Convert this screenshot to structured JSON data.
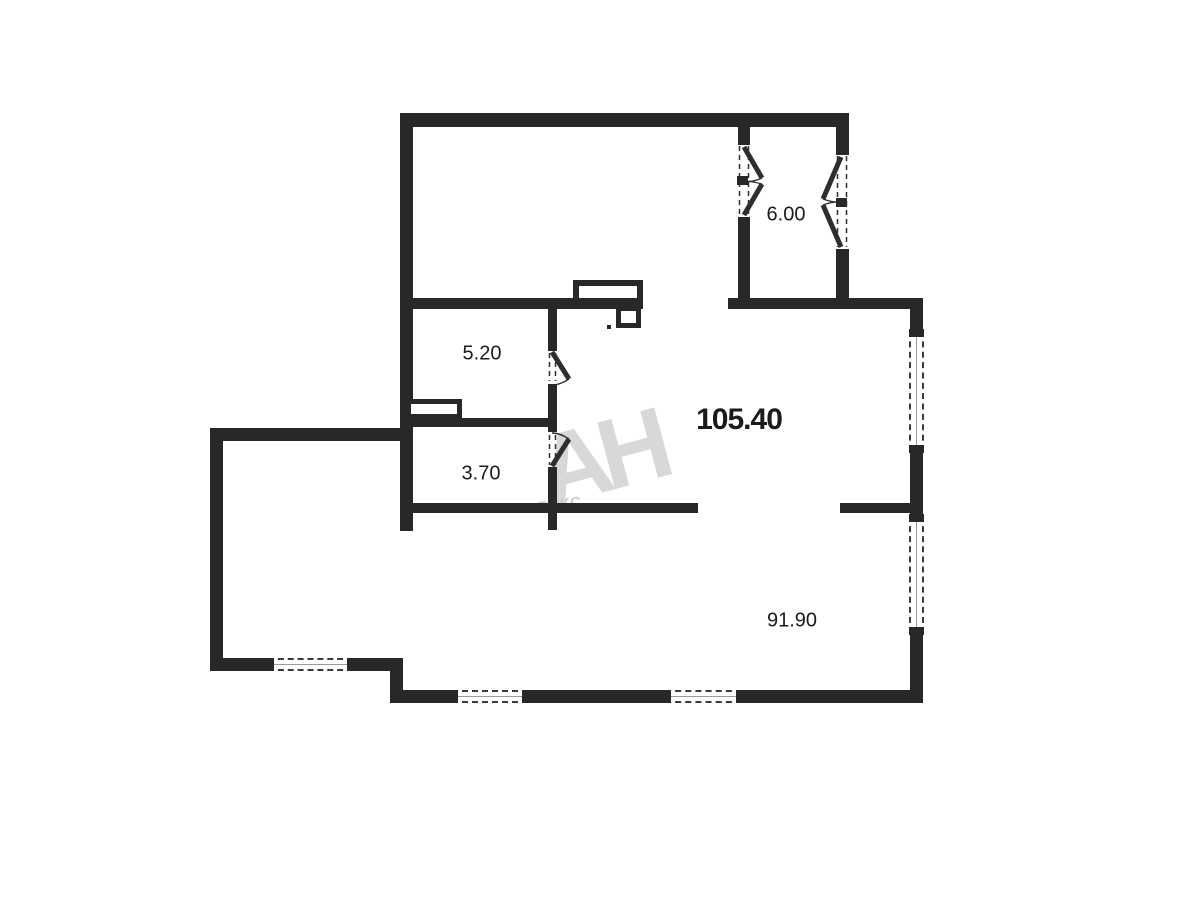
{
  "title": "apartment floor plan",
  "watermark": {
    "main": "АН",
    "sub": "РИКС"
  },
  "colors": {
    "wall": "#282828",
    "watermark": "#d8d8d8",
    "label": "#1b1b1b",
    "background": "#ffffff"
  },
  "rooms": [
    {
      "name": "balcony",
      "label": "6.00"
    },
    {
      "name": "bathroom",
      "label": "5.20"
    },
    {
      "name": "apartment-total",
      "label": "105.40"
    },
    {
      "name": "wc",
      "label": "3.70"
    },
    {
      "name": "main-room",
      "label": "91.90"
    }
  ]
}
